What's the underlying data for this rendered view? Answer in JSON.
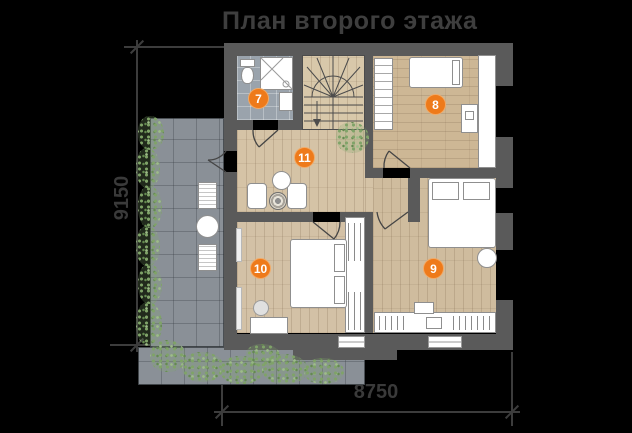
{
  "title": "План второго этажа",
  "dimensions": {
    "bottom": "8750",
    "left": "9150"
  },
  "rooms": [
    {
      "label": "7"
    },
    {
      "label": "8"
    },
    {
      "label": "9"
    },
    {
      "label": "10"
    },
    {
      "label": "11"
    }
  ],
  "colors": {
    "accent_marker": "#EE7A1A",
    "walls": "#5A5A5A",
    "wood_floor": "#D2BFA2",
    "bath_tile": "#9AA3AC",
    "terrace_tile": "#8A9097",
    "greenery": "#7FA368",
    "background": "#000000",
    "annotation_text": "#3A3A3A"
  }
}
